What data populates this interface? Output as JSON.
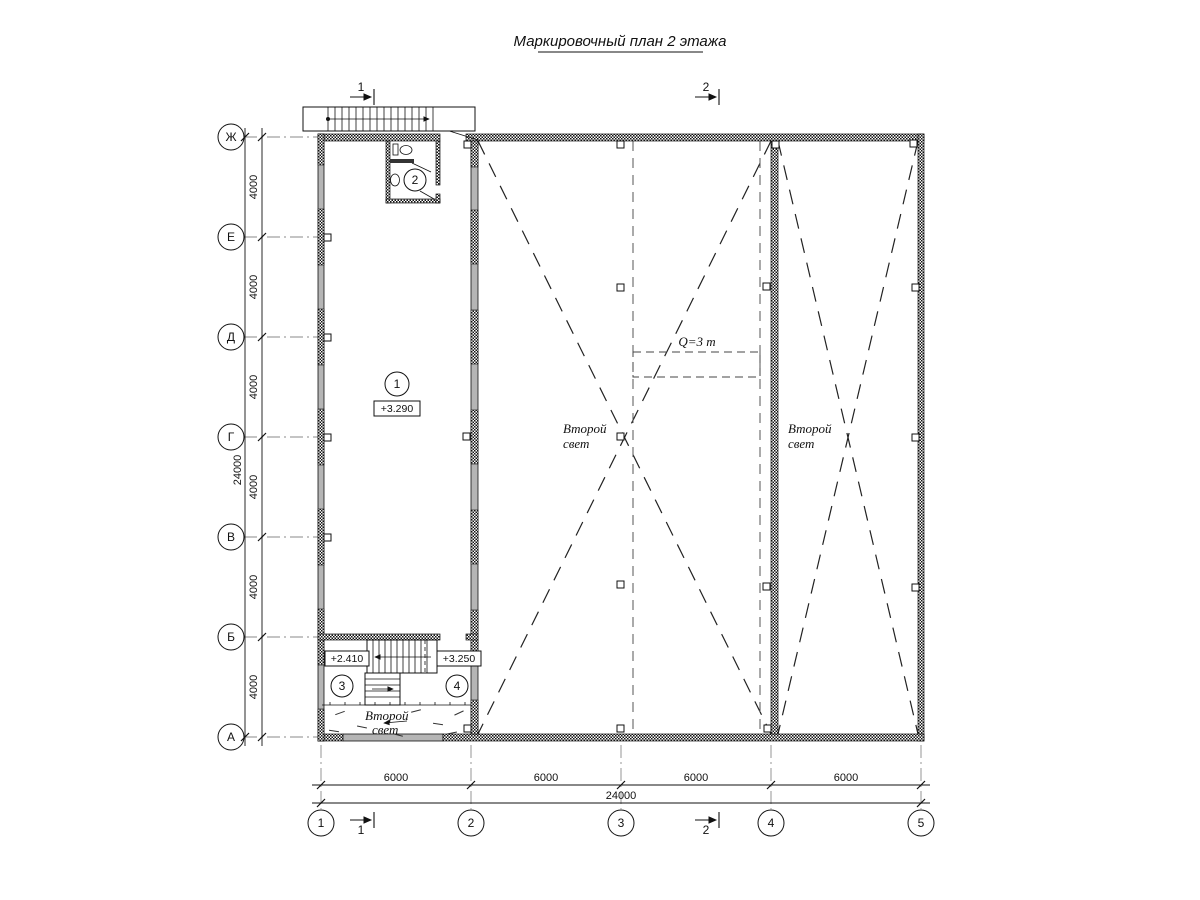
{
  "title": "Маркировочный план 2 этажа",
  "axes": {
    "rows": [
      {
        "label": "Ж"
      },
      {
        "label": "Е"
      },
      {
        "label": "Д"
      },
      {
        "label": "Г"
      },
      {
        "label": "В"
      },
      {
        "label": "Б"
      },
      {
        "label": "А"
      }
    ],
    "cols": [
      {
        "label": "1"
      },
      {
        "label": "2"
      },
      {
        "label": "3"
      },
      {
        "label": "4"
      },
      {
        "label": "5"
      }
    ]
  },
  "dimensions": {
    "left_segments": [
      "4000",
      "4000",
      "4000",
      "4000",
      "4000",
      "4000"
    ],
    "left_total": "24000",
    "bottom_segments": [
      "6000",
      "6000",
      "6000",
      "6000"
    ],
    "bottom_total": "24000"
  },
  "rooms": {
    "room1": {
      "number": "1",
      "elevation": "+3.290"
    },
    "room2": {
      "number": "2"
    },
    "room3": {
      "number": "3",
      "elevation": "+2.410"
    },
    "room4": {
      "number": "4",
      "elevation": "+3.250"
    }
  },
  "labels": {
    "second_light_line1": "Второй",
    "second_light_line2": "свет",
    "crane_capacity": "Q=3 т"
  },
  "sections": {
    "s1": "1",
    "s2": "2"
  }
}
